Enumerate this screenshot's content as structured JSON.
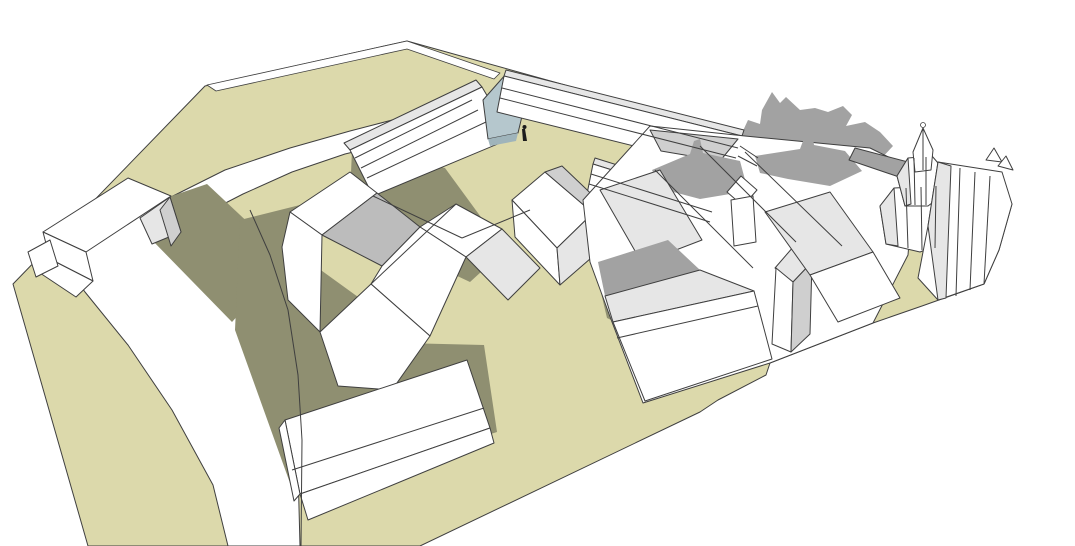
{
  "viewport": {
    "kind": "3d-massing-model-view",
    "background": "#ffffff"
  },
  "palette": {
    "outline": "#3f3f3f",
    "white": "#ffffff",
    "ground": "#dcd9ab",
    "groundShadow": "#8f8f71",
    "grayA": "#e6e6e6",
    "grayB": "#cfcfcf",
    "grayC": "#a2a2a2",
    "grayD": "#bcbcbc",
    "glass": "#b5c7cd",
    "glassDark": "#9fb4bb",
    "black": "#1c1c1c"
  },
  "scene": {
    "width": 1075,
    "height": 546,
    "polygons": [
      {
        "name": "ground-plane",
        "fill": "ground",
        "pts": "407,41 748,136 870,148 915,170 1012,204 999,250 984,284 922,306 873,323 770,363 766,375 718,400 700,412 420,546 88,546 13,284 205,86"
      },
      {
        "name": "boundary-fence",
        "fill": "white",
        "pts": "207,85 407,41 500,73 494,79 407,49 216,91",
        "w": 0.8
      },
      {
        "name": "road-surface",
        "fill": "white",
        "pts": "228,546 213,485 172,410 128,345 85,292 55,250 75,230 120,215 165,200 225,170 290,148 350,131 400,118 432,112 443,130 395,142 345,154 292,172 243,194 208,212 236,255 262,300 285,360 297,430 300,546"
      },
      {
        "name": "shadow-road-crossing",
        "fill": "groundShadow",
        "stroke": false,
        "pts": "160,200 207,184 288,260 232,322 150,238"
      },
      {
        "name": "shadow-central-houses",
        "fill": "groundShadow",
        "stroke": false,
        "pts": "240,220 312,202 300,255 365,302 358,342 484,345 497,432 295,497 235,330"
      },
      {
        "name": "shadow-courtyard-building",
        "fill": "groundShadow",
        "stroke": false,
        "pts": "352,150 445,168 505,250 470,282 385,242 350,196"
      },
      {
        "name": "shadow-lane",
        "fill": "groundShadow",
        "stroke": false,
        "pts": "588,238 612,250 632,330 607,318"
      },
      {
        "name": "cast-shadow-on-background",
        "fill": "grayC",
        "stroke": false,
        "pts": "718,137 733,130 742,133 748,120 760,124 762,110 772,92 780,103 786,97 800,110 815,108 828,112 843,106 852,115 846,126 865,122 880,132 893,146 878,162 852,154 820,150 790,147 758,150 733,146"
      },
      {
        "name": "back-roofs-gray",
        "fill": "grayB",
        "pts": "650,130 740,138 722,160 660,150"
      },
      {
        "name": "west-wing-roof-strip",
        "fill": "grayA",
        "pts": "344,143 476,80 482,87 350,150"
      },
      {
        "name": "west-wing-face",
        "fill": "white",
        "pts": "350,150 482,87 512,138 373,196"
      },
      {
        "name": "glass-facade",
        "fill": "glass",
        "pts": "483,100 506,74 528,91 518,133 488,139"
      },
      {
        "name": "glass-facade-lower",
        "fill": "glassDark",
        "stroke": false,
        "pts": "488,139 518,133 516,141 490,146"
      },
      {
        "name": "north-wing-roof-strip",
        "fill": "grayA",
        "pts": "506,70 744,130 742,136 504,76"
      },
      {
        "name": "north-wing-face",
        "fill": "white",
        "pts": "504,76 742,136 735,171 497,112"
      },
      {
        "name": "north-wing-endcap",
        "fill": "white",
        "pts": "742,136 762,148 755,176 735,171"
      },
      {
        "name": "east-wing-roof-strip",
        "fill": "grayA",
        "pts": "595,158 716,196 714,202 593,164"
      },
      {
        "name": "east-wing-face",
        "fill": "white",
        "pts": "593,164 714,202 708,232 587,194"
      },
      {
        "name": "left-building-roof",
        "fill": "white",
        "pts": "43,232 128,178 171,196 86,252"
      },
      {
        "name": "left-building-gable",
        "fill": "grayA",
        "pts": "140,218 170,197 181,232 152,244"
      },
      {
        "name": "left-building-gable-side",
        "fill": "grayB",
        "pts": "170,197 181,232 171,246 160,210"
      },
      {
        "name": "left-building-front",
        "fill": "white",
        "pts": "43,232 86,252 93,281 50,259"
      },
      {
        "name": "left-building-terrace",
        "fill": "white",
        "pts": "50,259 93,281 76,297 40,273"
      },
      {
        "name": "left-building-tip",
        "fill": "white",
        "pts": "28,252 50,240 58,266 36,277"
      },
      {
        "name": "house-roof-nw",
        "fill": "white",
        "pts": "290,212 350,172 377,193 322,235"
      },
      {
        "name": "house-roof-valley",
        "fill": "grayD",
        "pts": "322,235 377,193 420,227 382,266"
      },
      {
        "name": "house-roof-ne",
        "fill": "white",
        "pts": "420,227 456,204 502,229 466,257"
      },
      {
        "name": "house-roof-se",
        "fill": "grayA",
        "pts": "502,229 466,257 508,300 540,268"
      },
      {
        "name": "house-mid-roof",
        "fill": "white",
        "pts": "371,284 382,266 420,227 466,257 430,336"
      },
      {
        "name": "house-left-wall",
        "fill": "white",
        "pts": "290,212 322,235 320,332 288,300 282,247"
      },
      {
        "name": "house-gable-front",
        "fill": "white",
        "pts": "320,332 371,284 430,336 392,390 338,386"
      },
      {
        "name": "small-house-roof",
        "fill": "white",
        "pts": "512,200 545,172 593,213 557,248"
      },
      {
        "name": "small-house-roof-2",
        "fill": "grayB",
        "pts": "545,172 562,166 605,207 593,213"
      },
      {
        "name": "small-house-wall",
        "fill": "white",
        "pts": "512,200 557,248 560,285 515,237"
      },
      {
        "name": "small-house-gable",
        "fill": "grayA",
        "pts": "557,248 593,213 605,207 598,252 560,285"
      },
      {
        "name": "town-block-base",
        "fill": "white",
        "pts": "583,200 650,126 745,136 870,148 915,170 908,255 873,323 770,363 643,403 612,322 590,262"
      },
      {
        "name": "town-roof-back",
        "fill": "grayB",
        "pts": "650,130 738,139 720,161 661,151"
      },
      {
        "name": "town-roof-shadow-1",
        "fill": "grayC",
        "stroke": false,
        "pts": "652,170 690,154 694,141 700,139 703,153 740,161 748,191 700,199 662,189"
      },
      {
        "name": "town-roof-shadow-2",
        "fill": "grayC",
        "stroke": false,
        "pts": "755,156 800,149 806,133 812,131 814,145 845,151 862,171 830,186 788,179 760,173"
      },
      {
        "name": "town-slope-light",
        "fill": "grayA",
        "pts": "600,190 660,170 702,240 642,263"
      },
      {
        "name": "town-slope-dark",
        "fill": "grayC",
        "stroke": false,
        "pts": "598,262 668,240 700,270 605,296"
      },
      {
        "name": "town-roof-front",
        "fill": "grayA",
        "pts": "605,296 700,270 754,291 613,322"
      },
      {
        "name": "town-wall-front",
        "fill": "white",
        "pts": "613,322 754,291 772,359 645,401"
      },
      {
        "name": "tower1-roof",
        "fill": "white",
        "pts": "727,192 741,176 757,190 743,206"
      },
      {
        "name": "tower1-shaft",
        "fill": "white",
        "pts": "731,200 753,196 756,242 734,246"
      },
      {
        "name": "tower2-roof",
        "fill": "grayA",
        "pts": "775,268 794,246 812,262 793,282"
      },
      {
        "name": "tower2-shaft",
        "fill": "white",
        "pts": "776,268 793,282 791,352 772,344"
      },
      {
        "name": "tower2-side",
        "fill": "grayB",
        "pts": "793,282 812,262 810,334 791,352"
      },
      {
        "name": "town-bar-slope",
        "fill": "grayA",
        "pts": "765,212 830,192 873,252 810,275"
      },
      {
        "name": "town-bar-front",
        "fill": "white",
        "pts": "810,275 873,252 900,298 838,322"
      },
      {
        "name": "church-roof-band",
        "fill": "grayC",
        "pts": "855,148 908,162 902,178 849,160"
      },
      {
        "name": "church-tower-base",
        "fill": "white",
        "pts": "880,206 894,188 936,186 955,204 950,240 920,252 886,244"
      },
      {
        "name": "church-tower-base-facet",
        "fill": "grayA",
        "pts": "880,206 894,188 898,246 886,244"
      },
      {
        "name": "church-tower-drum",
        "fill": "white",
        "pts": "897,176 908,158 932,156 944,170 941,196 928,206 905,206"
      },
      {
        "name": "church-tower-drum-facet",
        "fill": "grayA",
        "pts": "897,176 908,158 911,204 905,206"
      },
      {
        "name": "church-spire",
        "fill": "white",
        "pts": "913,152 923,128 933,150 931,170 915,172"
      },
      {
        "name": "church-apse",
        "fill": "white",
        "pts": "938,162 1002,172 1012,204 999,250 984,284 938,300 918,278 928,226"
      },
      {
        "name": "church-apse-facet",
        "fill": "grayA",
        "pts": "938,162 951,166 946,298 938,300 928,226"
      },
      {
        "name": "church-pinnacle-1",
        "fill": "white",
        "pts": "986,160 994,148 1002,162"
      },
      {
        "name": "church-pinnacle-2",
        "fill": "white",
        "pts": "998,166 1006,156 1013,170"
      },
      {
        "name": "foreground-slab-roof",
        "fill": "white",
        "pts": "285,420 467,360 490,428 300,494"
      },
      {
        "name": "foreground-slab-front",
        "fill": "white",
        "pts": "300,494 490,428 494,443 308,520"
      },
      {
        "name": "foreground-slab-side",
        "fill": "white",
        "pts": "285,420 300,494 294,501 279,428"
      },
      {
        "name": "scale-figure-body",
        "fill": "black",
        "stroke": false,
        "pts": "522,129 525,129 527,141 523,141"
      }
    ],
    "lines": [
      {
        "name": "west-wing-band-1",
        "pts": "355,158 472,100"
      },
      {
        "name": "west-wing-band-2",
        "pts": "361,168 478,110"
      },
      {
        "name": "west-wing-band-3",
        "pts": "367,178 486,122"
      },
      {
        "name": "north-wing-band-1",
        "pts": "502,88 738,148"
      },
      {
        "name": "north-wing-band-2",
        "pts": "500,98 736,158"
      },
      {
        "name": "east-wing-band-1",
        "pts": "591,174 712,212"
      },
      {
        "name": "east-wing-band-2",
        "pts": "589,184 710,222"
      },
      {
        "name": "endcap-band-1",
        "pts": "740,146 758,158"
      },
      {
        "name": "endcap-band-2",
        "pts": "738,156 757,166"
      },
      {
        "name": "courtyard-edge-1",
        "pts": "373,196 462,238"
      },
      {
        "name": "courtyard-edge-2",
        "pts": "462,238 530,210"
      },
      {
        "name": "house-ridge",
        "pts": "371,284 456,204"
      },
      {
        "name": "town-ridge-1",
        "pts": "655,170 753,268"
      },
      {
        "name": "town-ridge-2",
        "pts": "700,146 796,242"
      },
      {
        "name": "town-ridge-3",
        "pts": "745,152 842,246"
      },
      {
        "name": "town-wall-band",
        "pts": "617,338 758,306"
      },
      {
        "name": "slab-band",
        "pts": "292,470 484,408"
      },
      {
        "name": "road-curb",
        "pts": "250,210 270,255 288,310 298,375 302,440 301,546"
      },
      {
        "name": "spire-edge",
        "pts": "923,128 923,170"
      },
      {
        "name": "drum-facet-1",
        "pts": "914,158 915,205"
      },
      {
        "name": "drum-facet-2",
        "pts": "926,157 926,205"
      },
      {
        "name": "base-facet-1",
        "pts": "906,188 908,248"
      },
      {
        "name": "base-facet-2",
        "pts": "921,187 922,250"
      },
      {
        "name": "base-facet-3",
        "pts": "936,186 935,248"
      },
      {
        "name": "apse-facet-1",
        "pts": "960,168 956,296"
      },
      {
        "name": "apse-facet-2",
        "pts": "975,172 970,290"
      },
      {
        "name": "apse-facet-3",
        "pts": "990,176 984,284"
      }
    ],
    "circles": [
      {
        "name": "scale-figure-head",
        "cx": 524.5,
        "cy": 127,
        "r": 2,
        "fill": "black"
      },
      {
        "name": "spire-knob",
        "cx": 923,
        "cy": 125,
        "r": 2.5,
        "fill": "white",
        "stroked": true
      }
    ]
  }
}
